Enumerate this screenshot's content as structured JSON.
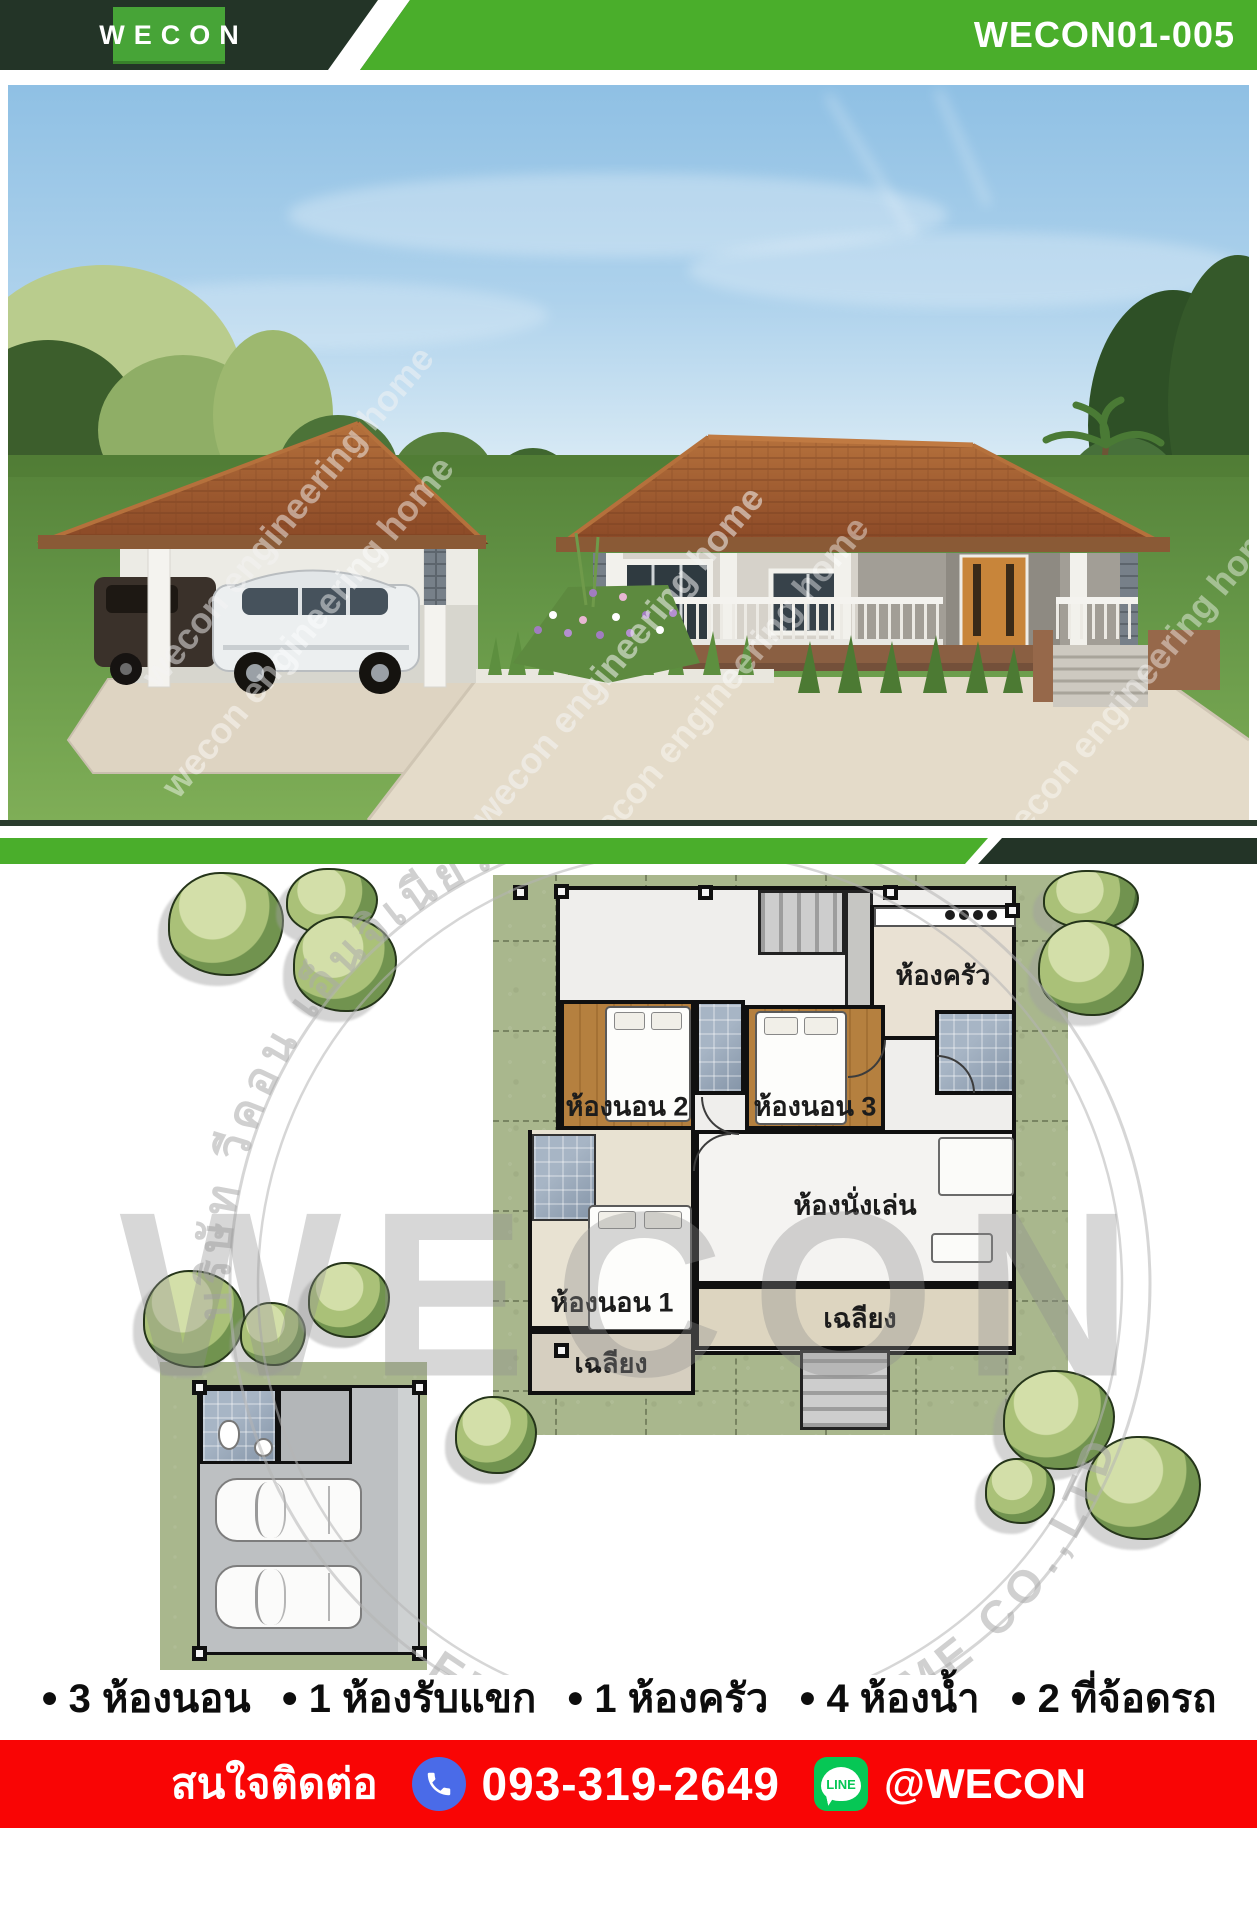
{
  "header": {
    "logo": "WECON",
    "code": "WECON01-005"
  },
  "photo": {
    "watermark": "wecon engineering home"
  },
  "plan": {
    "watermark_big": "WECON",
    "watermark_top": "บริษัท วีคอน เอ็นจิเนียริ่ง โฮม จำกัด",
    "watermark_bottom": "ENGINEERING HOME CO.,LTD",
    "rooms": {
      "kitchen": "ห้องครัว",
      "bedroom2": "ห้องนอน 2",
      "bedroom3": "ห้องนอน 3",
      "bedroom1": "ห้องนอน 1",
      "living": "ห้องนั่งเล่น",
      "porch_rear": "เฉลียง",
      "porch_side": "เฉลียง"
    }
  },
  "features": {
    "bullet": "●",
    "items": [
      "3 ห้องนอน",
      "1 ห้องรับแขก",
      "1 ห้องครัว",
      "4 ห้องน้ำ",
      "2 ที่จ้อดรถ"
    ]
  },
  "contact": {
    "label": "สนใจติดต่อ",
    "phone": "093-319-2649",
    "line_id": "@WECON",
    "line_badge": "LINE"
  },
  "colors": {
    "brand_green": "#4AAE2B",
    "brand_dark_green": "#233427",
    "contact_red": "#F90505",
    "phone_blue": "#4A6BE8",
    "line_green": "#06C755",
    "roof_terracotta": "#A05A30"
  }
}
